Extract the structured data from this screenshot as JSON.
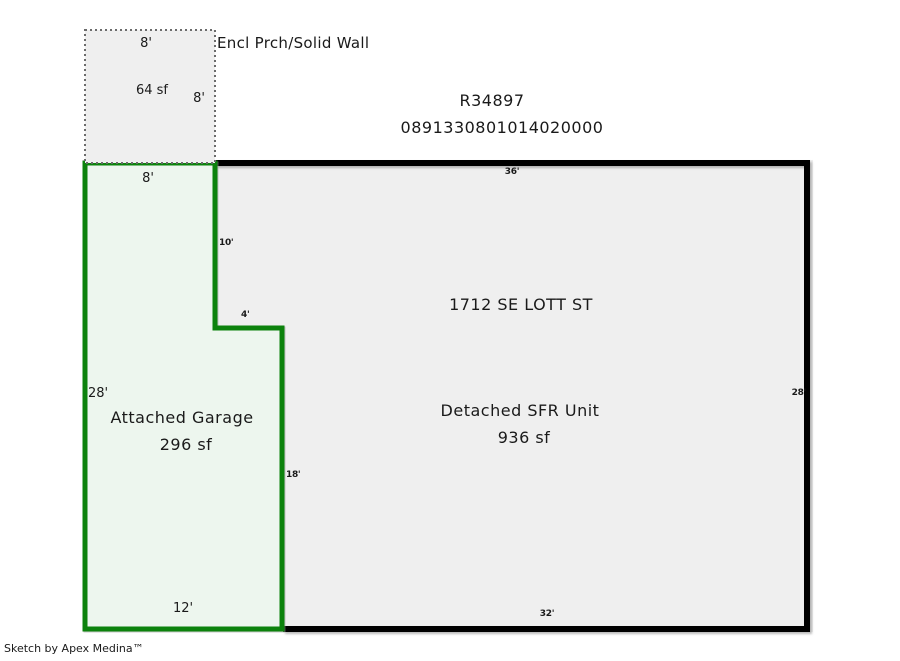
{
  "header": {
    "account_number": "R34897",
    "parcel_number": "0891330801014020000"
  },
  "porch": {
    "label": "Encl Prch/Solid Wall",
    "area_label": "64 sf",
    "dim_top": "8'",
    "dim_right": "8'"
  },
  "garage": {
    "name_label": "Attached Garage",
    "area_label": "296 sf",
    "dim_top": "8'",
    "dim_left": "28'",
    "dim_bottom": "12'",
    "dim_notch_vertical": "10'",
    "dim_notch_horizontal": "4'",
    "dim_right": "18'"
  },
  "main_unit": {
    "address_label": "1712 SE LOTT ST",
    "name_label": "Detached SFR Unit",
    "area_label": "936 sf",
    "dim_top": "36'",
    "dim_right": "28'",
    "dim_bottom": "32'"
  },
  "footer": {
    "credit": "Sketch by Apex Medina™"
  },
  "colors": {
    "main_fill": "#efefef",
    "main_border": "#000000",
    "garage_fill": "#edf6ee",
    "garage_border": "#0c820c",
    "porch_fill": "#efefef",
    "porch_border": "#6b6b6b"
  }
}
